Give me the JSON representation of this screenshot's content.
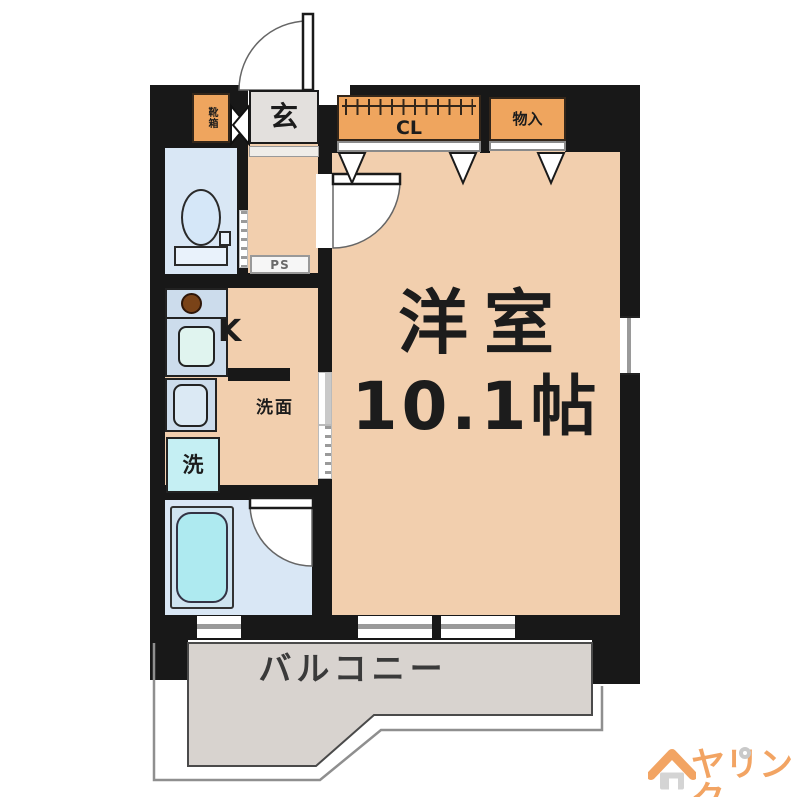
{
  "colors": {
    "wall": "#181818",
    "floor": "#f2cfae",
    "closet": "#efa55e",
    "wet": "#d9e7f5",
    "fixture_cyan": "#aeeaf0",
    "counter": "#ccdcec",
    "balcony": "#d8d3cf",
    "genkan": "#e3e0dd",
    "accent": "#f2a463"
  },
  "rooms": {
    "entrance": {
      "label": "玄"
    },
    "shoebox": {
      "label": "靴箱"
    },
    "closet": {
      "label": "CL"
    },
    "storage": {
      "label": "物入"
    },
    "pipe_shaft": {
      "label": "PS"
    },
    "kitchen": {
      "label": "K"
    },
    "washroom": {
      "label": "洗面"
    },
    "washing_machine": {
      "label": "洗"
    },
    "main_room": {
      "label": "洋室",
      "size": "10.1帖"
    },
    "balcony": {
      "label": "バルコニー"
    }
  },
  "icons": {
    "toilet": "toilet-icon",
    "bathtub": "bathtub-icon",
    "sink": "sink-icon",
    "basin": "basin-icon",
    "burner": "burner-icon",
    "hanger_rod": "hanger-rod-icon",
    "door_arc": "door-swing-icon",
    "house": "house-icon"
  },
  "logo": {
    "text": "ヤリンク"
  }
}
